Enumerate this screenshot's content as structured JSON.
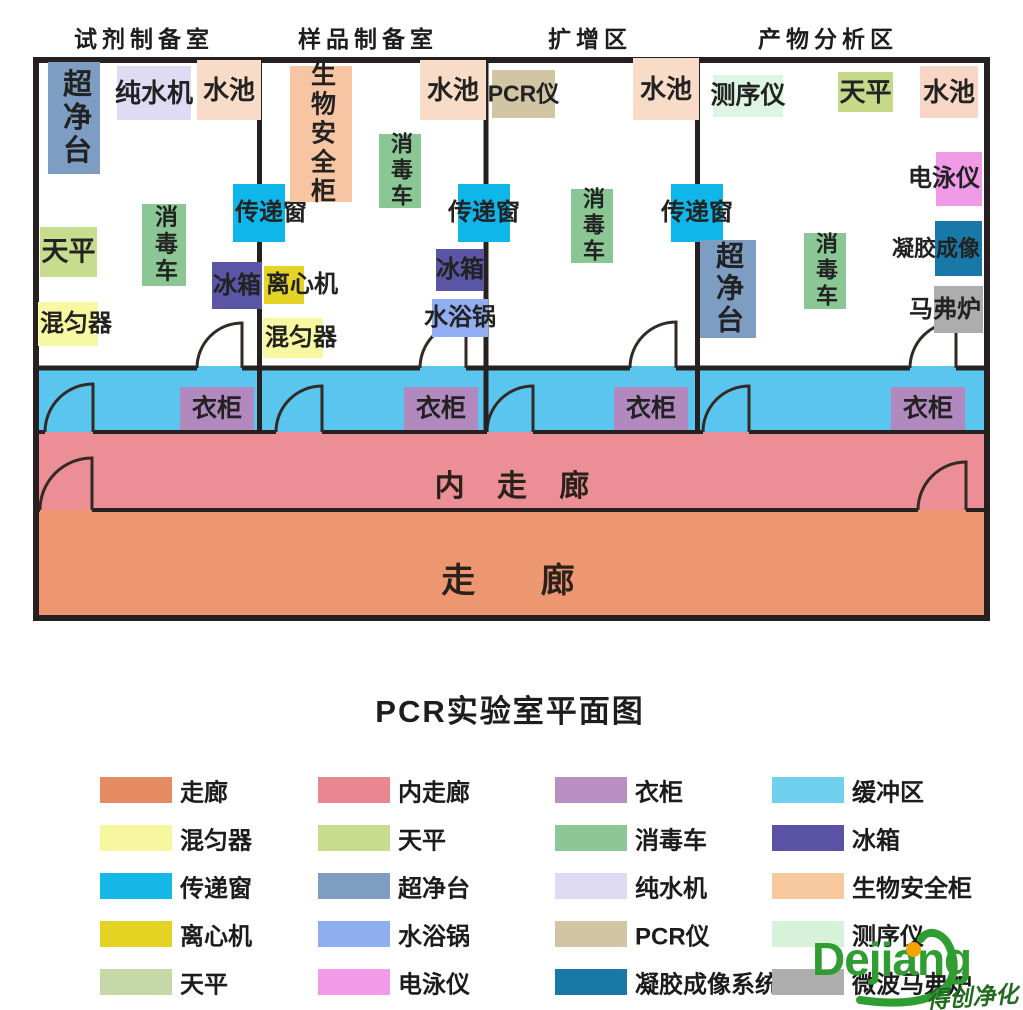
{
  "page": {
    "title": "PCR实验室平面图"
  },
  "room_headers": [
    {
      "id": "reagent-prep-room",
      "label": "试剂制备室",
      "cx": 144
    },
    {
      "id": "sample-prep-room",
      "label": "样品制备室",
      "cx": 368
    },
    {
      "id": "amplification-area",
      "label": "扩增区",
      "cx": 590
    },
    {
      "id": "product-analysis-area",
      "label": "产物分析区",
      "cx": 828
    }
  ],
  "areas": {
    "buffer_color": "#5AC6EF",
    "inner_corridor_color": "#EC8E95",
    "corridor_color": "#ED9770",
    "wall_color": "#262120",
    "inner_corridor_label": "内 走 廊",
    "corridor_label": "走 廊"
  },
  "equipment": [
    {
      "id": "clean-bench-1",
      "label": "超净台",
      "x": 48,
      "y": 62,
      "w": 52,
      "h": 112,
      "color": "#7E9DC2",
      "dir": "v",
      "tx": "c",
      "fs": 29
    },
    {
      "id": "water-purifier",
      "label": "纯水机",
      "x": 117,
      "y": 66,
      "w": 74,
      "h": 54,
      "color": "#DFDBF5",
      "dir": "h",
      "tx": "c",
      "fs": 26
    },
    {
      "id": "sink-1",
      "label": "水池",
      "x": 197,
      "y": 60,
      "w": 64,
      "h": 60,
      "color": "#F8DCC8",
      "dir": "h",
      "tx": "c",
      "fs": 26
    },
    {
      "id": "pass-box-1",
      "label": "传递窗",
      "x": 233,
      "y": 184,
      "w": 52,
      "h": 58,
      "color": "#0FB6EA",
      "dir": "h",
      "tx": "l",
      "fs": 24
    },
    {
      "id": "disinfect-cart-1",
      "label": "消毒车",
      "x": 142,
      "y": 204,
      "w": 44,
      "h": 82,
      "color": "#8BC795",
      "dir": "v",
      "tx": "c",
      "fs": 23
    },
    {
      "id": "balance-1",
      "label": "天平",
      "x": 40,
      "y": 227,
      "w": 57,
      "h": 50,
      "color": "#C8DC8E",
      "dir": "h",
      "tx": "c",
      "fs": 27
    },
    {
      "id": "fridge-1",
      "label": "冰箱",
      "x": 212,
      "y": 262,
      "w": 50,
      "h": 47,
      "color": "#5A55A5",
      "dir": "h",
      "tx": "c",
      "fs": 24
    },
    {
      "id": "mixer-1",
      "label": "混匀器",
      "x": 38,
      "y": 302,
      "w": 60,
      "h": 44,
      "color": "#F8F8A2",
      "dir": "h",
      "tx": "l",
      "fs": 24
    },
    {
      "id": "biosafety-cabinet",
      "label": "生物安全柜",
      "x": 290,
      "y": 66,
      "w": 62,
      "h": 136,
      "color": "#F7C5A2",
      "dir": "v",
      "tx": "c",
      "fs": 25
    },
    {
      "id": "sink-2",
      "label": "水池",
      "x": 420,
      "y": 60,
      "w": 66,
      "h": 60,
      "color": "#F8DCC8",
      "dir": "h",
      "tx": "c",
      "fs": 26
    },
    {
      "id": "disinfect-cart-2",
      "label": "消毒车",
      "x": 379,
      "y": 134,
      "w": 42,
      "h": 74,
      "color": "#8BC795",
      "dir": "v",
      "tx": "c",
      "fs": 22
    },
    {
      "id": "pass-box-2",
      "label": "传递窗",
      "x": 458,
      "y": 184,
      "w": 52,
      "h": 58,
      "color": "#0FB6EA",
      "dir": "h",
      "tx": "c",
      "fs": 24
    },
    {
      "id": "centrifuge",
      "label": "离心机",
      "x": 264,
      "y": 266,
      "w": 40,
      "h": 38,
      "color": "#E5D426",
      "dir": "h",
      "tx": "l",
      "fs": 24
    },
    {
      "id": "fridge-2",
      "label": "冰箱",
      "x": 436,
      "y": 249,
      "w": 48,
      "h": 42,
      "color": "#5A55A5",
      "dir": "h",
      "tx": "c",
      "fs": 24
    },
    {
      "id": "water-bath",
      "label": "水浴锅",
      "x": 432,
      "y": 299,
      "w": 56,
      "h": 38,
      "color": "#91AEF2",
      "dir": "h",
      "tx": "c",
      "fs": 24
    },
    {
      "id": "mixer-2",
      "label": "混匀器",
      "x": 263,
      "y": 318,
      "w": 60,
      "h": 40,
      "color": "#F8F8A2",
      "dir": "h",
      "tx": "l",
      "fs": 24
    },
    {
      "id": "pcr-machine",
      "label": "PCR仪",
      "x": 492,
      "y": 70,
      "w": 63,
      "h": 48,
      "color": "#D2C5A4",
      "dir": "h",
      "tx": "c",
      "fs": 23
    },
    {
      "id": "sink-3",
      "label": "水池",
      "x": 633,
      "y": 58,
      "w": 66,
      "h": 62,
      "color": "#F8DCC8",
      "dir": "h",
      "tx": "c",
      "fs": 26
    },
    {
      "id": "disinfect-cart-3",
      "label": "消毒车",
      "x": 571,
      "y": 189,
      "w": 42,
      "h": 74,
      "color": "#8BC795",
      "dir": "v",
      "tx": "c",
      "fs": 22
    },
    {
      "id": "pass-box-3",
      "label": "传递窗",
      "x": 671,
      "y": 184,
      "w": 52,
      "h": 58,
      "color": "#0FB6EA",
      "dir": "h",
      "tx": "c",
      "fs": 24
    },
    {
      "id": "sequencer",
      "label": "测序仪",
      "x": 713,
      "y": 75,
      "w": 70,
      "h": 42,
      "color": "#DFF5E3",
      "dir": "h",
      "tx": "c",
      "fs": 25
    },
    {
      "id": "balance-2",
      "label": "天平",
      "x": 838,
      "y": 72,
      "w": 55,
      "h": 40,
      "color": "#C5D989",
      "dir": "h",
      "tx": "c",
      "fs": 26
    },
    {
      "id": "sink-4",
      "label": "水池",
      "x": 920,
      "y": 66,
      "w": 58,
      "h": 52,
      "color": "#F7D6C5",
      "dir": "h",
      "tx": "c",
      "fs": 26
    },
    {
      "id": "electrophoresis",
      "label": "电泳仪",
      "x": 936,
      "y": 152,
      "w": 46,
      "h": 54,
      "color": "#F09AE8",
      "dir": "h",
      "tx": "r",
      "fs": 24
    },
    {
      "id": "gel-imaging",
      "label": "凝胶成像",
      "x": 935,
      "y": 221,
      "w": 47,
      "h": 55,
      "color": "#1879A8",
      "dir": "h",
      "tx": "r",
      "fs": 22
    },
    {
      "id": "muffle-furnace",
      "label": "马弗炉",
      "x": 934,
      "y": 286,
      "w": 49,
      "h": 47,
      "color": "#ADADAD",
      "dir": "h",
      "tx": "r",
      "fs": 24
    },
    {
      "id": "disinfect-cart-4",
      "label": "消毒车",
      "x": 804,
      "y": 233,
      "w": 42,
      "h": 76,
      "color": "#8BC795",
      "dir": "v",
      "tx": "c",
      "fs": 22
    },
    {
      "id": "clean-bench-2",
      "label": "超净台",
      "x": 700,
      "y": 240,
      "w": 56,
      "h": 98,
      "color": "#7E9DC2",
      "dir": "v",
      "tx": "c",
      "fs": 28
    },
    {
      "id": "wardrobe-1",
      "label": "衣柜",
      "x": 180,
      "y": 387,
      "w": 74,
      "h": 43,
      "color": "#B289BE",
      "dir": "h",
      "tx": "c",
      "fs": 25
    },
    {
      "id": "wardrobe-2",
      "label": "衣柜",
      "x": 404,
      "y": 387,
      "w": 74,
      "h": 43,
      "color": "#B289BE",
      "dir": "h",
      "tx": "c",
      "fs": 25
    },
    {
      "id": "wardrobe-3",
      "label": "衣柜",
      "x": 614,
      "y": 387,
      "w": 74,
      "h": 43,
      "color": "#B289BE",
      "dir": "h",
      "tx": "c",
      "fs": 25
    },
    {
      "id": "wardrobe-4",
      "label": "衣柜",
      "x": 891,
      "y": 387,
      "w": 74,
      "h": 43,
      "color": "#B289BE",
      "dir": "h",
      "tx": "c",
      "fs": 25
    }
  ],
  "legend": [
    {
      "id": "corridor",
      "label": "走廊",
      "color": "#E58B63"
    },
    {
      "id": "inner-corridor",
      "label": "内走廊",
      "color": "#E8878F"
    },
    {
      "id": "wardrobe",
      "label": "衣柜",
      "color": "#B98FC2"
    },
    {
      "id": "buffer-zone",
      "label": "缓冲区",
      "color": "#6FD0EF"
    },
    {
      "id": "mixer",
      "label": "混匀器",
      "color": "#F7F7A0"
    },
    {
      "id": "balance",
      "label": "天平",
      "color": "#C7DC8F"
    },
    {
      "id": "disinfect-cart",
      "label": "消毒车",
      "color": "#8CC795"
    },
    {
      "id": "fridge",
      "label": "冰箱",
      "color": "#5952A5"
    },
    {
      "id": "pass-box",
      "label": "传递窗",
      "color": "#16B8E8"
    },
    {
      "id": "clean-bench",
      "label": "超净台",
      "color": "#7E9DC0"
    },
    {
      "id": "water-purifier",
      "label": "纯水机",
      "color": "#DFDBF5"
    },
    {
      "id": "biosafety-cabinet",
      "label": "生物安全柜",
      "color": "#F8C99F"
    },
    {
      "id": "centrifuge",
      "label": "离心机",
      "color": "#E3D323"
    },
    {
      "id": "water-bath",
      "label": "水浴锅",
      "color": "#8FAEF0"
    },
    {
      "id": "pcr-machine",
      "label": "PCR仪",
      "color": "#D2C5A4"
    },
    {
      "id": "sequencer",
      "label": "测序仪",
      "color": "#D6F2D8"
    },
    {
      "id": "balance-alt",
      "label": "天平",
      "color": "#C6D8A8"
    },
    {
      "id": "electrophoresis",
      "label": "电泳仪",
      "color": "#F29BE8"
    },
    {
      "id": "gel-imaging-system",
      "label": "凝胶成像系统",
      "color": "#1879A8"
    },
    {
      "id": "microwave-muffle-furnace",
      "label": "微波马弗炉",
      "color": "#ADADAD"
    }
  ],
  "logo": {
    "brand": "Dejiang",
    "tagline": "得创净化",
    "brand_color": "#2F9D32",
    "dot_color": "#F5A300"
  }
}
